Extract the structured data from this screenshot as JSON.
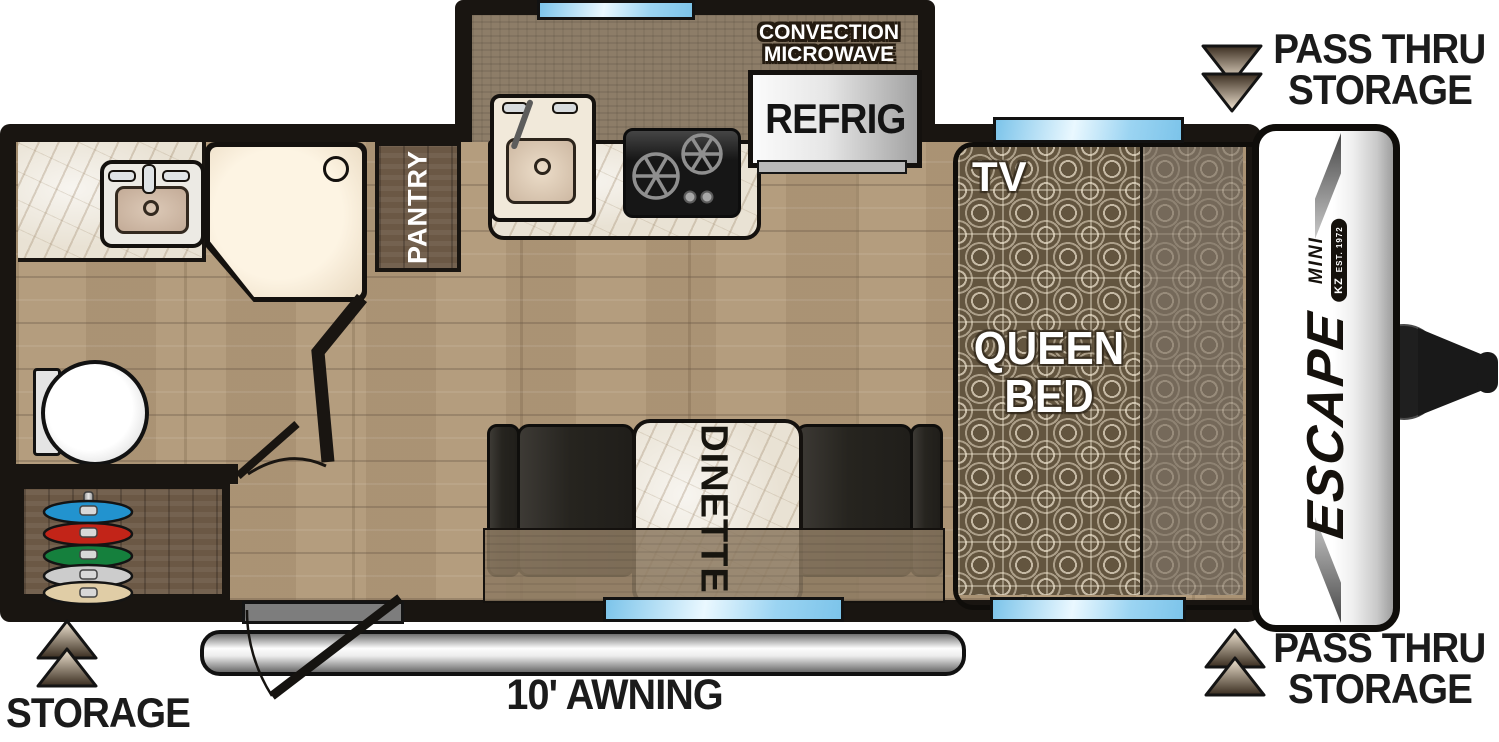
{
  "labels": {
    "pass_thru_top": {
      "line1": "PASS THRU",
      "line2": "STORAGE"
    },
    "pass_thru_bottom": {
      "line1": "PASS THRU",
      "line2": "STORAGE"
    },
    "rear_storage": "STORAGE",
    "awning": "10' AWNING",
    "pantry": "PANTRY",
    "dinette": "DINETTE",
    "tv": "TV",
    "queen_bed": {
      "line1": "QUEEN",
      "line2": "BED"
    },
    "microwave": {
      "line1": "CONVECTION",
      "line2": "MICROWAVE"
    },
    "refrigerator": "REFRIG",
    "logo": {
      "brand": "ESCAPE",
      "model": "MINI",
      "badge": "KZ",
      "est": "EST. 1972"
    }
  },
  "colors": {
    "wall_black": "#191511",
    "window_blue": "#9bd4f2",
    "floor_wood": "#b49d7e",
    "cabinet_wood": "#6b5845",
    "counter_brown": "#8d7d68",
    "marble": "#e9e2d4",
    "bench_dark": "#26241f",
    "bed_pattern_base": "#63553f",
    "arrow_dark": "#3a2d20",
    "arrow_light": "#f3e7d4"
  },
  "storage_rack_discs": [
    {
      "name": "blue",
      "color": "#2293cf"
    },
    {
      "name": "red",
      "color": "#c22418"
    },
    {
      "name": "green",
      "color": "#15803d"
    },
    {
      "name": "silver",
      "color": "#cccccc"
    },
    {
      "name": "tan",
      "color": "#e0cda6"
    }
  ]
}
